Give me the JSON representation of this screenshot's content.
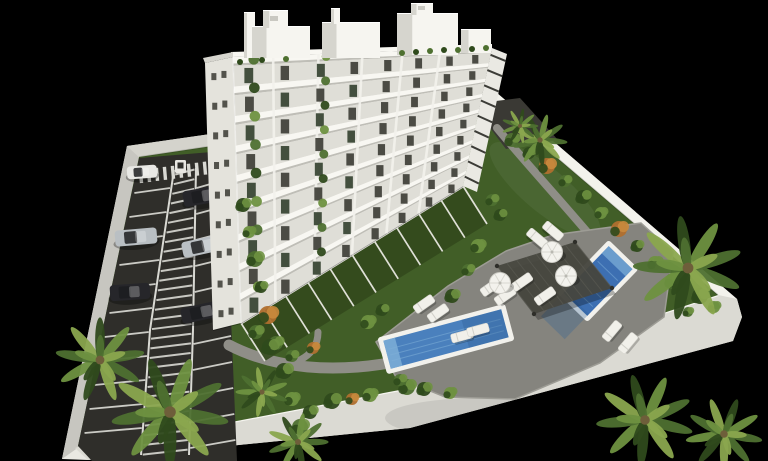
{
  "meta": {
    "title": "aerial-3d-render-of-residential-complex",
    "view": "bird's-eye 3D architectural visualization on black background"
  },
  "colors": {
    "background": "#000000",
    "wall_top": "#e9e8e2",
    "wall_sunlit": "#f3f2ec",
    "wall_shade": "#c7c6c0",
    "wall_face": "#dbdad3",
    "wall_band_nw": "#d4d3cc",
    "grass": "#415e27",
    "grass_light": "#4c6c2e",
    "grass_dark": "#33491d",
    "asphalt": "#2f2e2a",
    "asphalt_light": "#3a3934",
    "marking": "#d9d9d3",
    "deck": "#85847e",
    "deck_edge": "#9d9c95",
    "path": "#8f8e87",
    "pool_coping": "#f2f1ec",
    "water_main": "#4a80bd",
    "water_light": "#7fb0d8",
    "water_deep": "#2f5f96",
    "water_small": "#3d6fb2",
    "pergola": "#47473f",
    "bldg_front": "#f3f2ed",
    "bldg_side": "#e4e3dc",
    "bldg_right": "#eae9e3",
    "bldg_recess": "#dfded7",
    "bldg_slab": "#f8f7f2",
    "bldg_shadowline": "#bfbeb7",
    "window": "#42423c",
    "glass_green": "#3a4736",
    "railing": "#3c3c37",
    "roof_shade": "#d6d5ce",
    "plant": "#4e7030",
    "plant_dark": "#2f4a1c",
    "plant_light": "#6e9140",
    "palm_light": "#8aa64e",
    "orange_bush": "#b06f2e",
    "car_silver": "#b9bfc3",
    "car_dark": "#26262a",
    "car_white": "#e8e8e4",
    "car_glass": "#1c1d20"
  },
  "scene": {
    "building": {
      "floors": 9,
      "roof_structures": 8,
      "label": "white apartment block with balconies"
    },
    "parking": {
      "cars": 6,
      "driveway_cars": 1,
      "label": "fenced surface parking with hatched median and crosswalk"
    },
    "pools": {
      "count": 2,
      "label": "two blue swimming pools with white coping"
    },
    "furniture": {
      "parasols": 3,
      "sun_loungers": 12,
      "pergolas": 1
    },
    "vegetation": {
      "palm_trees": 9,
      "shrub_clusters": 41
    }
  }
}
